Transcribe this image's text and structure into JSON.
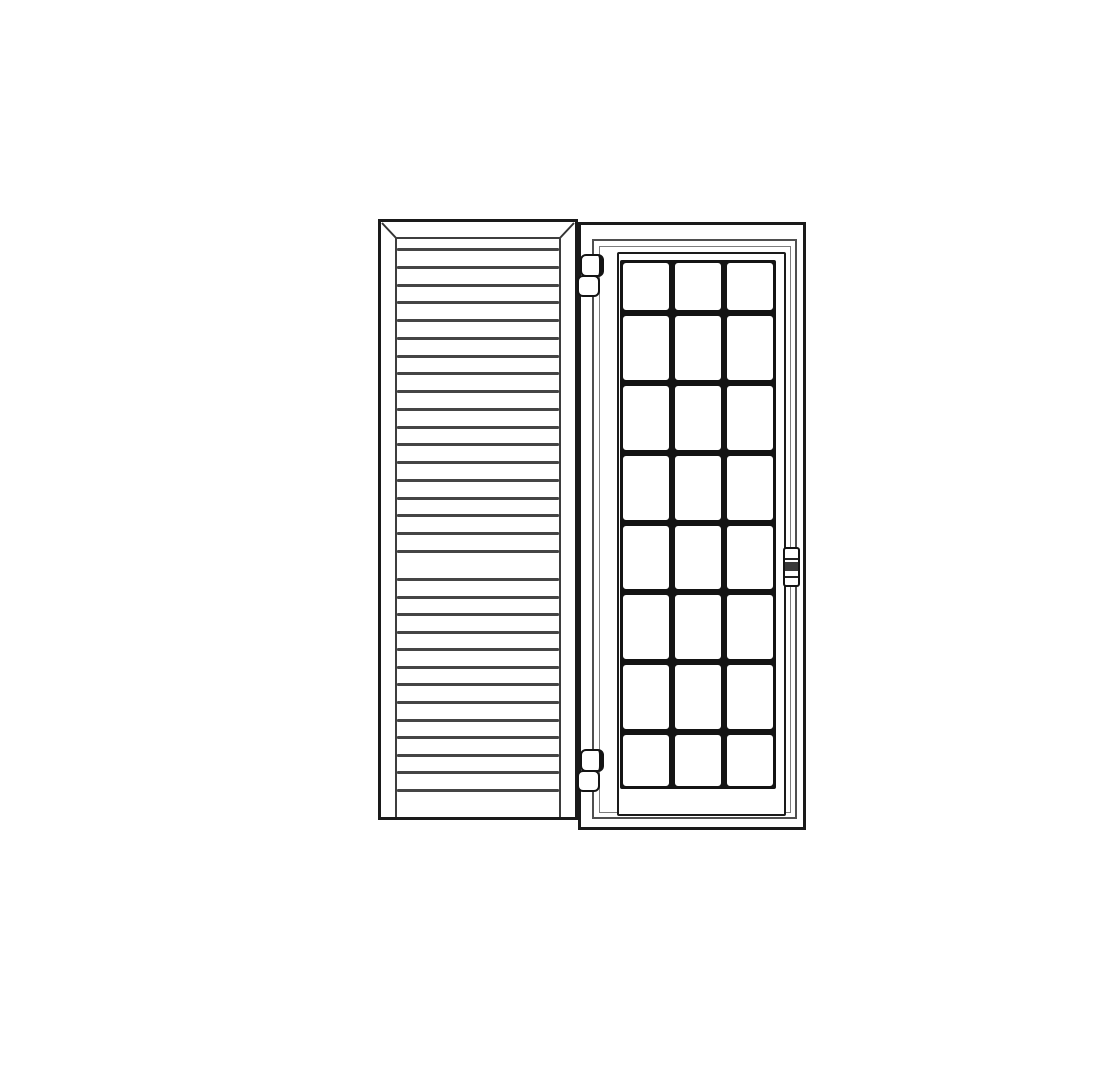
{
  "drawing": {
    "subject": "Line drawing of a louvered shutter panel beside a hinged glazed door with a divided-lite glass grid",
    "colors": {
      "outline": "#1a1a1a",
      "louver_line": "#454545",
      "stile_line": "#3d3d3d",
      "frame_line": "#4f4f4f",
      "thin_line": "#7d7d7d",
      "muntin": "#141414",
      "fill": "#ffffff"
    },
    "shutter": {
      "louvers_upper": 18,
      "louvers_lower": 13,
      "has_mid_rail": true,
      "mitered_top_corners": true
    },
    "door": {
      "lite_rows": 8,
      "lite_columns": 3,
      "hinge_count": 2,
      "hinge_side": "left",
      "handle_side": "right"
    }
  }
}
